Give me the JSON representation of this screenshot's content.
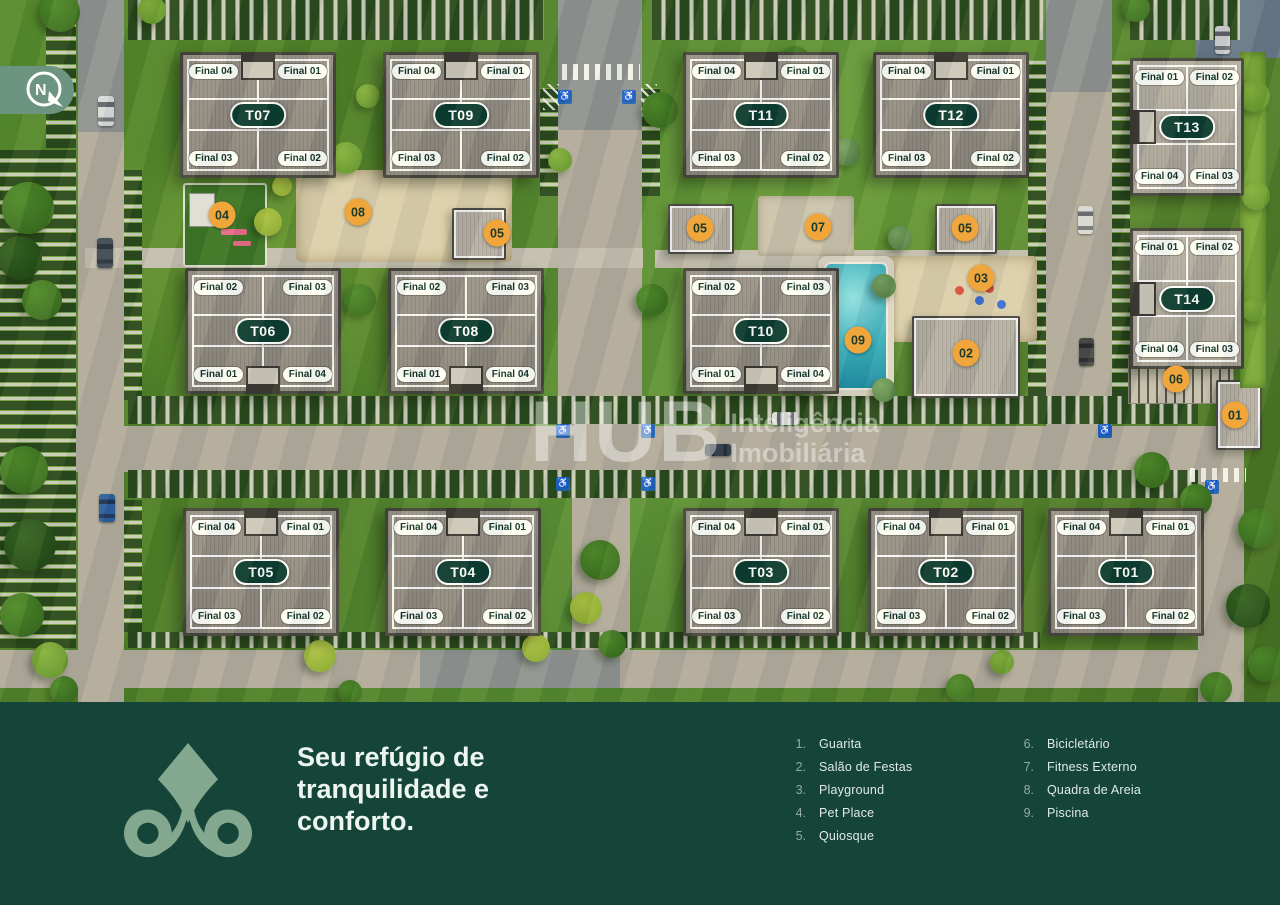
{
  "compass": {
    "label": "N"
  },
  "watermark": {
    "brand": "HUB",
    "subtitle": "Inteligência\nImobiliária"
  },
  "footer": {
    "tagline": "Seu refúgio de\ntranquilidade e\nconforto."
  },
  "legend": {
    "columns": [
      {
        "items": [
          {
            "n": "1.",
            "label": "Guarita"
          },
          {
            "n": "2.",
            "label": "Salão de Festas"
          },
          {
            "n": "3.",
            "label": "Playground"
          },
          {
            "n": "4.",
            "label": "Pet Place"
          },
          {
            "n": "5.",
            "label": "Quiosque"
          }
        ]
      },
      {
        "items": [
          {
            "n": "6.",
            "label": "Bicicletário"
          },
          {
            "n": "7.",
            "label": "Fitness Externo"
          },
          {
            "n": "8.",
            "label": "Quadra de Areia"
          },
          {
            "n": "9.",
            "label": "Piscina"
          }
        ]
      }
    ]
  },
  "colors": {
    "footer_bg": "#154439",
    "logo": "#84a78f",
    "badge_bg": "#f1a63b",
    "tower_pill_bg": "#0c3b31",
    "pool": "#2da4b4",
    "accessible_blue": "#1e63b5"
  },
  "towers": [
    {
      "id": "T07",
      "x": 180,
      "y": 52,
      "w": 150,
      "h": 120,
      "notch": "top",
      "style": "std",
      "tl": "Final 04",
      "tr": "Final 01",
      "bl": "Final 03",
      "br": "Final 02"
    },
    {
      "id": "T09",
      "x": 383,
      "y": 52,
      "w": 150,
      "h": 120,
      "notch": "top",
      "style": "std",
      "tl": "Final 04",
      "tr": "Final 01",
      "bl": "Final 03",
      "br": "Final 02"
    },
    {
      "id": "T11",
      "x": 683,
      "y": 52,
      "w": 150,
      "h": 120,
      "notch": "top",
      "style": "std",
      "tl": "Final 04",
      "tr": "Final 01",
      "bl": "Final 03",
      "br": "Final 02"
    },
    {
      "id": "T12",
      "x": 873,
      "y": 52,
      "w": 150,
      "h": 120,
      "notch": "top",
      "style": "std",
      "tl": "Final 04",
      "tr": "Final 01",
      "bl": "Final 03",
      "br": "Final 02"
    },
    {
      "id": "T13",
      "x": 1130,
      "y": 58,
      "w": 108,
      "h": 132,
      "notch": "left",
      "style": "light",
      "tl": "Final 01",
      "tr": "Final 02",
      "bl": "Final 04",
      "br": "Final 03"
    },
    {
      "id": "T06",
      "x": 185,
      "y": 268,
      "w": 150,
      "h": 120,
      "notch": "bottom",
      "style": "std",
      "tl": "Final 02",
      "tr": "Final 03",
      "bl": "Final 01",
      "br": "Final 04"
    },
    {
      "id": "T08",
      "x": 388,
      "y": 268,
      "w": 150,
      "h": 120,
      "notch": "bottom",
      "style": "std",
      "tl": "Final 02",
      "tr": "Final 03",
      "bl": "Final 01",
      "br": "Final 04"
    },
    {
      "id": "T10",
      "x": 683,
      "y": 268,
      "w": 150,
      "h": 120,
      "notch": "bottom",
      "style": "std",
      "tl": "Final 02",
      "tr": "Final 03",
      "bl": "Final 01",
      "br": "Final 04"
    },
    {
      "id": "T14",
      "x": 1130,
      "y": 228,
      "w": 108,
      "h": 135,
      "notch": "left",
      "style": "light",
      "tl": "Final 01",
      "tr": "Final 02",
      "bl": "Final 04",
      "br": "Final 03"
    },
    {
      "id": "T05",
      "x": 183,
      "y": 508,
      "w": 150,
      "h": 122,
      "notch": "top",
      "style": "std",
      "tl": "Final 04",
      "tr": "Final 01",
      "bl": "Final 03",
      "br": "Final 02"
    },
    {
      "id": "T04",
      "x": 385,
      "y": 508,
      "w": 150,
      "h": 122,
      "notch": "top",
      "style": "std",
      "tl": "Final 04",
      "tr": "Final 01",
      "bl": "Final 03",
      "br": "Final 02"
    },
    {
      "id": "T03",
      "x": 683,
      "y": 508,
      "w": 150,
      "h": 122,
      "notch": "top",
      "style": "std",
      "tl": "Final 04",
      "tr": "Final 01",
      "bl": "Final 03",
      "br": "Final 02"
    },
    {
      "id": "T02",
      "x": 868,
      "y": 508,
      "w": 150,
      "h": 122,
      "notch": "top",
      "style": "std",
      "tl": "Final 04",
      "tr": "Final 01",
      "bl": "Final 03",
      "br": "Final 02"
    },
    {
      "id": "T01",
      "x": 1048,
      "y": 508,
      "w": 150,
      "h": 122,
      "notch": "top",
      "style": "std",
      "tl": "Final 04",
      "tr": "Final 01",
      "bl": "Final 03",
      "br": "Final 02"
    }
  ],
  "badges": [
    [
      "04",
      222,
      215
    ],
    [
      "08",
      358,
      212
    ],
    [
      "05",
      497,
      233
    ],
    [
      "05",
      700,
      228
    ],
    [
      "07",
      818,
      227
    ],
    [
      "05",
      965,
      228
    ],
    [
      "03",
      981,
      278
    ],
    [
      "09",
      858,
      340
    ],
    [
      "02",
      966,
      353
    ],
    [
      "06",
      1176,
      379
    ],
    [
      "01",
      1235,
      415
    ]
  ],
  "map": {
    "roads": [
      [
        78,
        0,
        46,
        702,
        "road"
      ],
      [
        558,
        0,
        84,
        430,
        "road"
      ],
      [
        0,
        426,
        1244,
        46,
        "road"
      ],
      [
        0,
        650,
        1244,
        38,
        "road"
      ],
      [
        1046,
        0,
        66,
        428,
        "road"
      ],
      [
        572,
        498,
        58,
        154,
        "road"
      ],
      [
        1198,
        428,
        46,
        274,
        "road"
      ],
      [
        85,
        248,
        558,
        20,
        "path"
      ],
      [
        655,
        250,
        390,
        18,
        "path"
      ],
      [
        78,
        0,
        46,
        132,
        "shade"
      ],
      [
        558,
        0,
        84,
        130,
        "shade"
      ],
      [
        1046,
        0,
        66,
        92,
        "shade"
      ],
      [
        1196,
        0,
        84,
        58,
        "pave"
      ],
      [
        420,
        650,
        200,
        38,
        "shade"
      ]
    ],
    "parking": [
      [
        128,
        0,
        416,
        40,
        "v"
      ],
      [
        652,
        0,
        392,
        40,
        "v"
      ],
      [
        46,
        0,
        30,
        148,
        "h"
      ],
      [
        0,
        150,
        76,
        498,
        "h"
      ],
      [
        124,
        170,
        18,
        230,
        "h"
      ],
      [
        124,
        500,
        18,
        132,
        "h"
      ],
      [
        128,
        396,
        1070,
        28,
        "v"
      ],
      [
        128,
        470,
        1070,
        28,
        "v"
      ],
      [
        540,
        88,
        18,
        108,
        "h"
      ],
      [
        642,
        88,
        18,
        108,
        "h"
      ],
      [
        1028,
        60,
        18,
        336,
        "h"
      ],
      [
        1112,
        60,
        18,
        336,
        "h"
      ],
      [
        1130,
        0,
        110,
        40,
        "v"
      ],
      [
        128,
        632,
        912,
        16,
        "v"
      ]
    ],
    "features": [
      {
        "t": "sand",
        "x": 296,
        "y": 170,
        "w": 216,
        "h": 92
      },
      {
        "t": "petplace",
        "x": 183,
        "y": 183,
        "w": 80,
        "h": 80
      },
      {
        "t": "quiosque",
        "x": 452,
        "y": 208,
        "w": 50,
        "h": 48
      },
      {
        "t": "quiosque",
        "x": 668,
        "y": 204,
        "w": 62,
        "h": 46
      },
      {
        "t": "quiosque",
        "x": 935,
        "y": 204,
        "w": 58,
        "h": 46
      },
      {
        "t": "pad",
        "x": 758,
        "y": 196,
        "w": 96,
        "h": 60
      },
      {
        "t": "playground",
        "x": 885,
        "y": 256,
        "w": 152,
        "h": 86
      },
      {
        "t": "pool",
        "x": 818,
        "y": 256,
        "w": 76,
        "h": 140
      },
      {
        "t": "salon",
        "x": 912,
        "y": 316,
        "w": 104,
        "h": 78
      },
      {
        "t": "bike",
        "x": 1128,
        "y": 354,
        "w": 104,
        "h": 48
      },
      {
        "t": "guarita",
        "x": 1216,
        "y": 380,
        "w": 42,
        "h": 66
      },
      {
        "t": "hedge",
        "x": 1240,
        "y": 52,
        "w": 26,
        "h": 336
      },
      {
        "t": "cross",
        "x": 562,
        "y": 64,
        "w": 78,
        "h": 16
      },
      {
        "t": "cross",
        "x": 1190,
        "y": 468,
        "w": 56,
        "h": 14
      },
      {
        "t": "hatch",
        "x": 543,
        "y": 84,
        "w": 16,
        "h": 26
      },
      {
        "t": "hatch",
        "x": 641,
        "y": 84,
        "w": 16,
        "h": 26
      }
    ],
    "tiles": [
      [
        558,
        90
      ],
      [
        622,
        90
      ],
      [
        556,
        424
      ],
      [
        641,
        424
      ],
      [
        556,
        477
      ],
      [
        641,
        477
      ],
      [
        1098,
        424
      ],
      [
        1205,
        480
      ]
    ],
    "cars": [
      [
        98,
        96,
        16,
        30,
        "#d9dbdb",
        "v"
      ],
      [
        97,
        238,
        16,
        30,
        "#3f4a57",
        "v"
      ],
      [
        99,
        494,
        16,
        28,
        "#2d5f9f",
        "v"
      ],
      [
        772,
        412,
        26,
        13,
        "#dcdcda",
        "h"
      ],
      [
        705,
        444,
        26,
        12,
        "#394250",
        "h"
      ],
      [
        1078,
        206,
        15,
        28,
        "#d8d8d6",
        "v"
      ],
      [
        1079,
        338,
        15,
        28,
        "#4a4a4a",
        "v"
      ],
      [
        1215,
        26,
        15,
        28,
        "#cfd0d2",
        "v"
      ]
    ],
    "trees": [
      [
        28,
        208,
        26,
        "mid"
      ],
      [
        20,
        258,
        22,
        "dark"
      ],
      [
        42,
        300,
        20,
        "mid"
      ],
      [
        24,
        470,
        24,
        "mid"
      ],
      [
        30,
        545,
        26,
        "dark"
      ],
      [
        22,
        615,
        22,
        "mid"
      ],
      [
        50,
        660,
        18,
        "light"
      ],
      [
        60,
        12,
        20,
        "mid"
      ],
      [
        152,
        10,
        14,
        "light"
      ],
      [
        346,
        158,
        16,
        "light"
      ],
      [
        368,
        96,
        12,
        "light"
      ],
      [
        268,
        222,
        14,
        "yellow"
      ],
      [
        282,
        186,
        10,
        "yellow"
      ],
      [
        360,
        300,
        16,
        "mid"
      ],
      [
        528,
        300,
        18,
        "mid"
      ],
      [
        524,
        102,
        16,
        "mid"
      ],
      [
        560,
        160,
        12,
        "light"
      ],
      [
        660,
        110,
        18,
        "mid"
      ],
      [
        652,
        300,
        16,
        "mid"
      ],
      [
        600,
        560,
        20,
        "mid"
      ],
      [
        586,
        608,
        16,
        "yellow"
      ],
      [
        612,
        644,
        14,
        "mid"
      ],
      [
        795,
        62,
        16,
        "mid"
      ],
      [
        846,
        152,
        14,
        "sage"
      ],
      [
        900,
        238,
        12,
        "sage"
      ],
      [
        806,
        300,
        14,
        "sage"
      ],
      [
        884,
        286,
        12,
        "sage"
      ],
      [
        808,
        382,
        14,
        "sage"
      ],
      [
        884,
        390,
        12,
        "sage"
      ],
      [
        1136,
        8,
        14,
        "mid"
      ],
      [
        1254,
        96,
        16,
        "light"
      ],
      [
        1256,
        196,
        14,
        "light"
      ],
      [
        1254,
        310,
        12,
        "light"
      ],
      [
        1152,
        470,
        18,
        "mid"
      ],
      [
        1196,
        500,
        16,
        "mid"
      ],
      [
        1258,
        528,
        20,
        "mid"
      ],
      [
        1248,
        606,
        22,
        "dark"
      ],
      [
        1266,
        664,
        18,
        "mid"
      ],
      [
        1216,
        688,
        16,
        "mid"
      ],
      [
        320,
        656,
        16,
        "yellow"
      ],
      [
        64,
        690,
        14,
        "mid"
      ],
      [
        350,
        692,
        12,
        "mid"
      ],
      [
        960,
        688,
        14,
        "mid"
      ],
      [
        1002,
        662,
        12,
        "light"
      ],
      [
        536,
        648,
        14,
        "yellow"
      ]
    ]
  }
}
